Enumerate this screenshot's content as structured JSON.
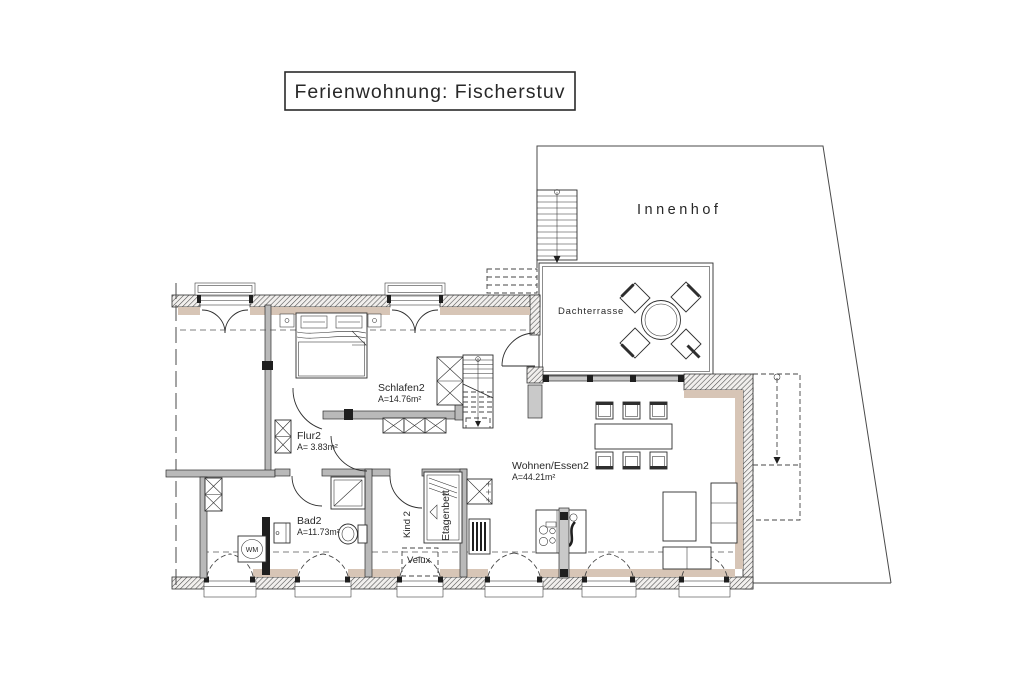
{
  "title": "Ferienwohnung: Fischerstuv",
  "site": {
    "courtyard": "Innenhof",
    "terrace": "Dachterrasse"
  },
  "rooms": {
    "schlafen2": {
      "label": "Schlafen2",
      "area": "A=14.76m²"
    },
    "flur2": {
      "label": "Flur2",
      "area": "A= 3.83m²"
    },
    "wohnen_essen2": {
      "label": "Wohnen/Essen2",
      "area": "A=44.21m²"
    },
    "bad2": {
      "label": "Bad2",
      "area": "A=11.73m²"
    },
    "kind2": {
      "label": "Kind 2"
    }
  },
  "annotations": {
    "bunk_bed": "Etagenbett",
    "washing_machine": "WM",
    "roof_window": "Velux"
  },
  "colors": {
    "line": "#2e2e2e",
    "wall_hatch": "#4a4a4a",
    "wall_band_tan": "#d7c5b6",
    "wall_gray": "#b9b9b9",
    "paper": "#ffffff"
  }
}
